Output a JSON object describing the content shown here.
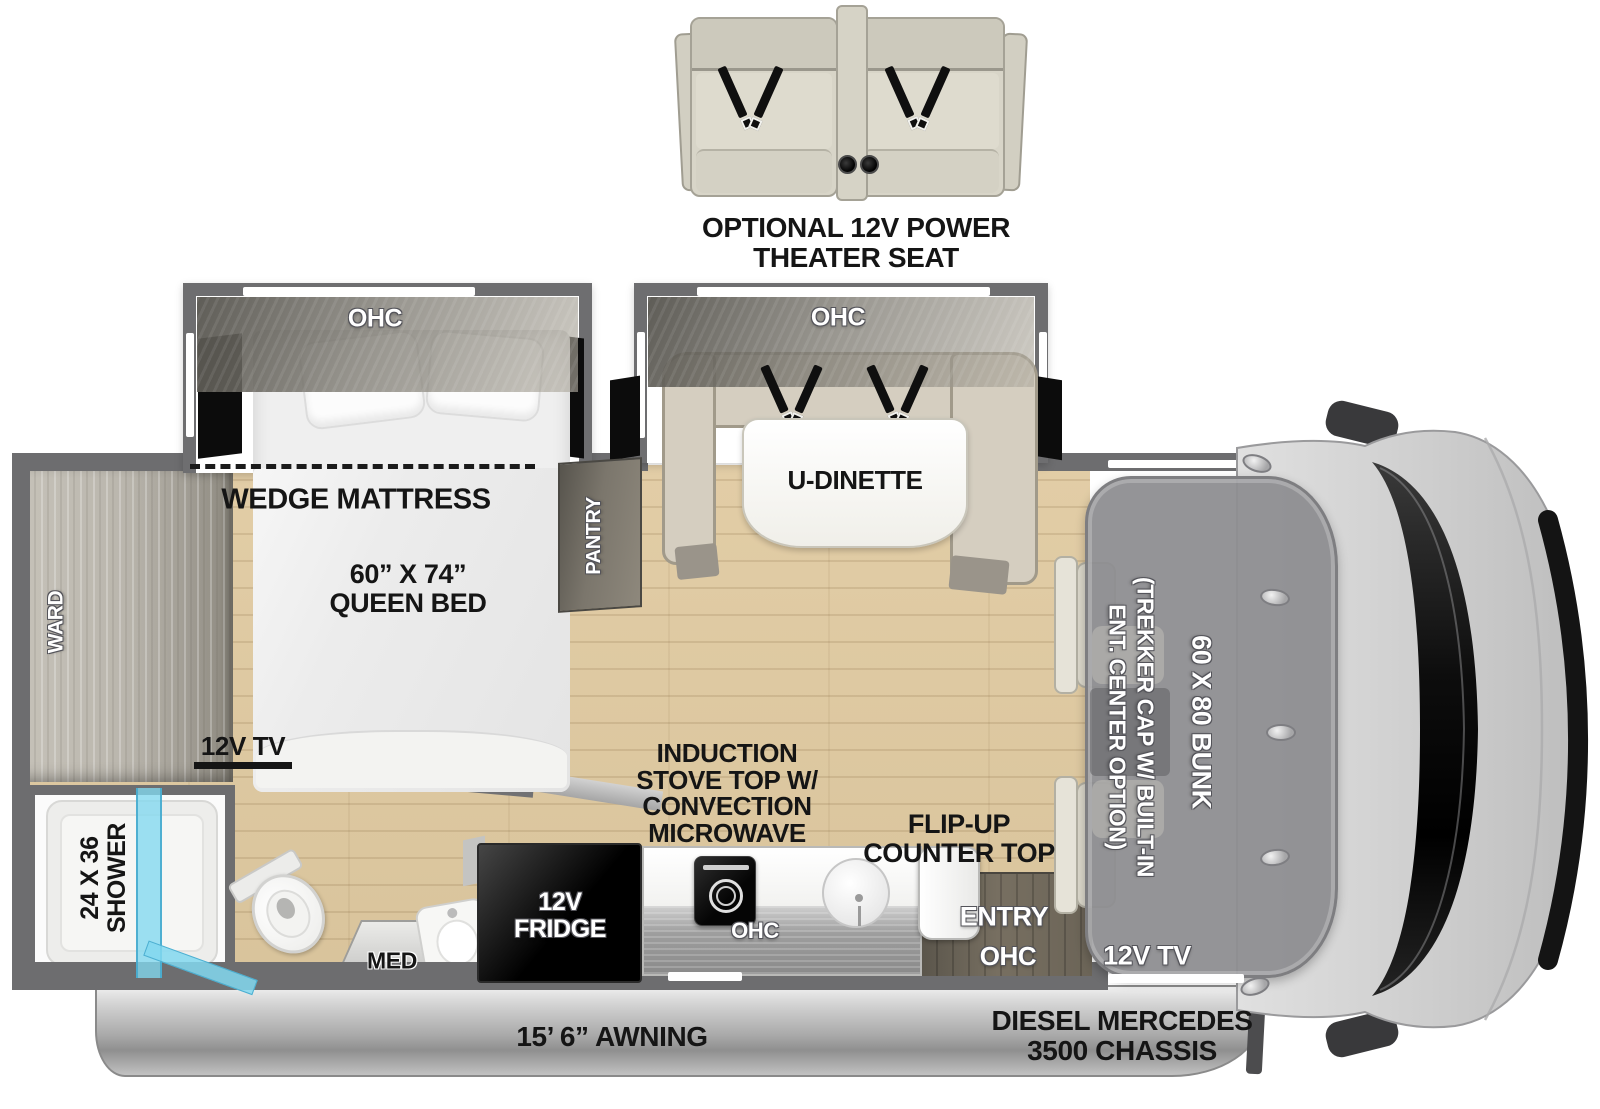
{
  "floorplan": {
    "theater_seat_option": {
      "label_line1": "OPTIONAL 12V POWER",
      "label_line2": "THEATER SEAT"
    },
    "bedroom": {
      "ohc": "OHC",
      "wedge_mattress": "WEDGE MATTRESS",
      "bed_size": "60” X 74”",
      "bed_type": "QUEEN BED",
      "tv": "12V TV",
      "pantry": "PANTRY",
      "ward": "WARD"
    },
    "dinette": {
      "ohc": "OHC",
      "table": "U-DINETTE"
    },
    "bathroom": {
      "shower_line1": "24 X 36",
      "shower_line2": "SHOWER",
      "med": "MED"
    },
    "kitchen": {
      "fridge_line1": "12V",
      "fridge_line2": "FRIDGE",
      "stove_lines": [
        "INDUCTION",
        "STOVE TOP W/",
        "CONVECTION",
        "MICROWAVE"
      ],
      "ohc": "OHC",
      "flip_line1": "FLIP-UP",
      "flip_line2": "COUNTER TOP"
    },
    "entry": {
      "label": "ENTRY",
      "ohc": "OHC"
    },
    "cab": {
      "tv": "12V TV",
      "bunk": "60 X 80 BUNK",
      "cap_line1": "(TREKKER CAP W/ BUILT-IN",
      "cap_line2": "ENT. CENTER OPTION)"
    },
    "exterior": {
      "awning": "15’ 6” AWNING",
      "chassis_line1": "DIESEL MERCEDES",
      "chassis_line2": "3500 CHASSIS"
    },
    "colors": {
      "floor": "#ddc79f",
      "wall": "#6d6d6f",
      "shower_glass": "#82d8f0",
      "bench": "#d5cec0",
      "cab_body": "#d2d2d2",
      "bunk": "#8e8e90"
    }
  }
}
